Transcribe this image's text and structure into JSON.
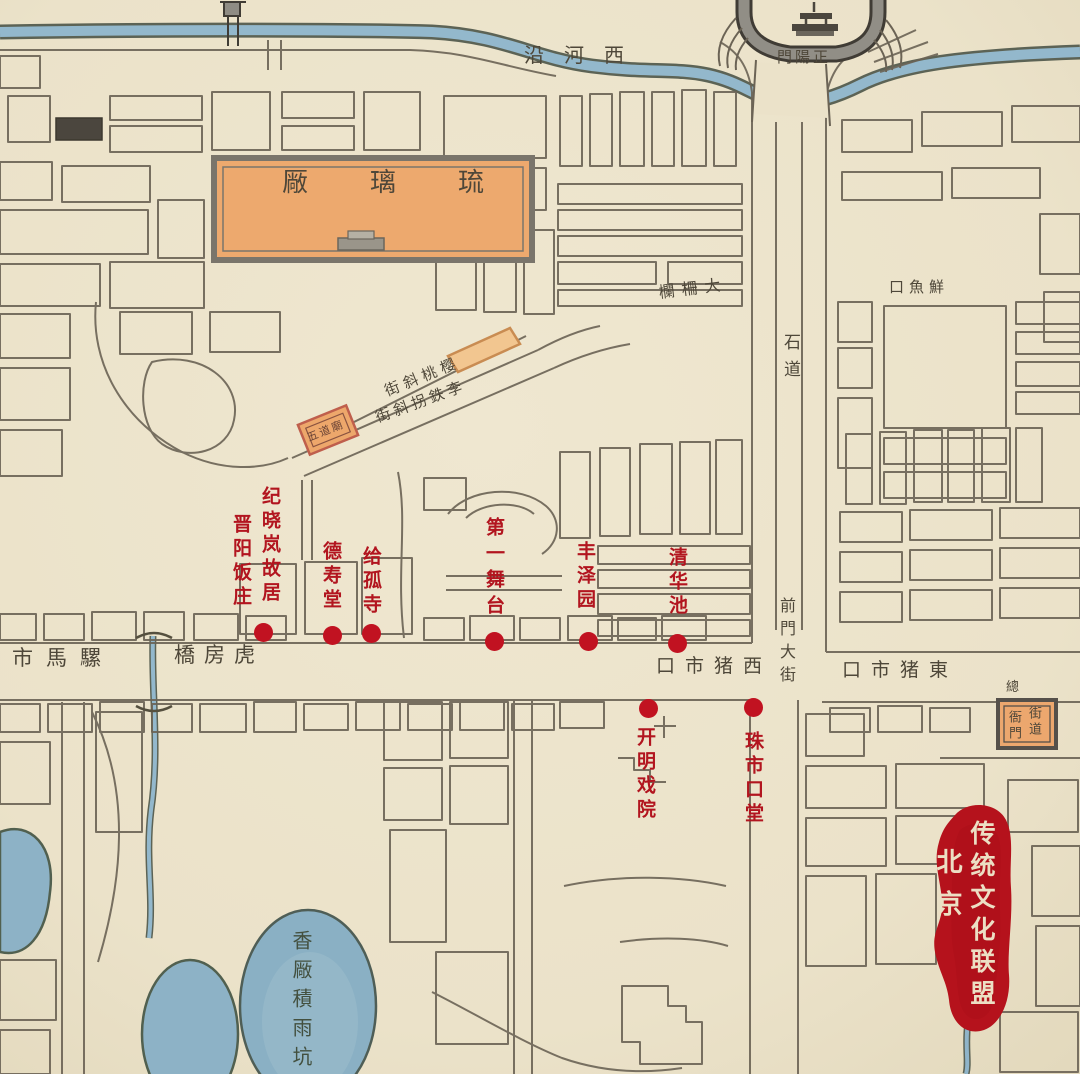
{
  "street_labels": {
    "xiheyan": "沿河西",
    "zhengyangmen": "門陽正",
    "dazhalan": "欄柵大",
    "xianyukou": "口魚鮮",
    "shidao": "石道",
    "qianmen_dajie": "前門大街",
    "luomashi": "市馬騾",
    "hufangqiao": "橋房虎",
    "xi_zhushikou": "口市猪西",
    "dong_zhushikou": "口市猪東",
    "yingtao_xiejie": "街斜桃樱",
    "litieguai_xiejie": "街斜拐鉄李"
  },
  "building_labels": {
    "liulichang": "厰璃琉",
    "wudaomiao": "五道廟",
    "yamen_outer": "總",
    "yamen_col_right": "街道",
    "yamen_col_left": "衙門"
  },
  "water_labels": {
    "pond": "香厰積雨坑"
  },
  "poi_markers": [
    {
      "name": "纪晓岚故居晋阳饭庄",
      "columns": [
        "纪晓岚故居",
        "晋阳饭庄"
      ]
    },
    {
      "name": "德寿堂",
      "columns": [
        "德寿堂"
      ]
    },
    {
      "name": "给孤寺",
      "columns": [
        "给孤寺"
      ]
    },
    {
      "name": "第一舞台",
      "columns": [
        "第一舞台"
      ]
    },
    {
      "name": "丰泽园",
      "columns": [
        "丰泽园"
      ]
    },
    {
      "name": "清华池",
      "columns": [
        "清华池"
      ]
    },
    {
      "name": "开明戏院",
      "columns": [
        "开明戏院"
      ]
    },
    {
      "name": "珠市口堂",
      "columns": [
        "珠市口堂"
      ]
    }
  ],
  "seal": {
    "col_right": "传统文化联盟",
    "col_left": "北京"
  },
  "colors": {
    "marker_red": "#c11221",
    "label_red": "#b2151f",
    "seal_red": "#b5121c",
    "water_blue": "#8fb4c9",
    "building_orange": "#eda968",
    "ink": "#554f42",
    "paper": "#ebe2c9"
  }
}
